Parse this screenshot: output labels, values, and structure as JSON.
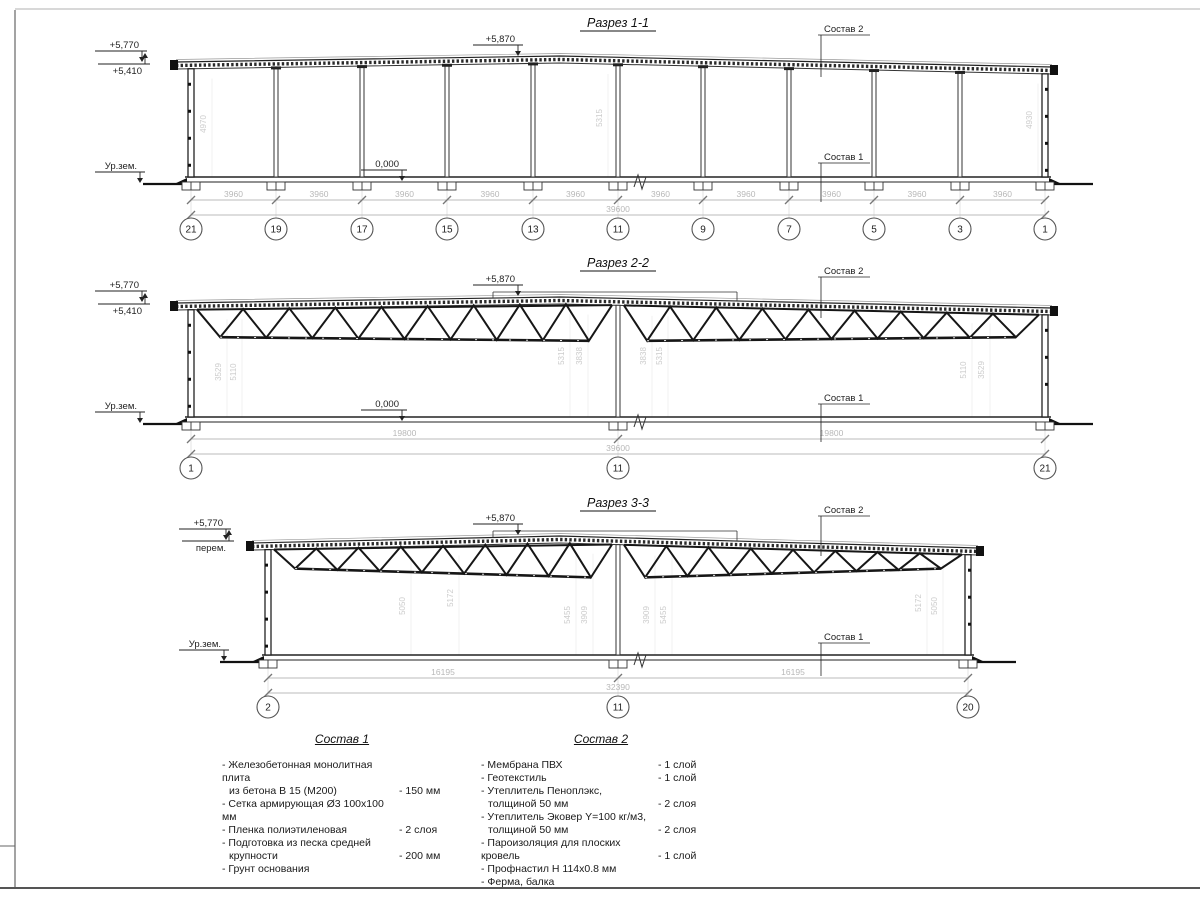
{
  "drawing": {
    "sections": {
      "s1": {
        "title": "Разрез 1-1",
        "elev_high": "+5,770",
        "elev_low": "+5,410",
        "ground_label": "Ур.зем.",
        "zero_mark": "0,000",
        "ridge": "+5,870",
        "sostav2_label": "Состав 2",
        "sostav1_label": "Состав 1",
        "bay_dims": [
          "3960",
          "3960",
          "3960",
          "3960",
          "3960",
          "3960",
          "3960",
          "3960",
          "3960",
          "3960"
        ],
        "total_dim": "39600",
        "axes": [
          "21",
          "19",
          "17",
          "15",
          "13",
          "11",
          "9",
          "7",
          "5",
          "3",
          "1"
        ],
        "vert_dims": [
          "4970",
          "5315",
          "4930"
        ]
      },
      "s2": {
        "title": "Разрез 2-2",
        "elev_high": "+5,770",
        "elev_low": "+5,410",
        "ground_label": "Ур.зем.",
        "zero_mark": "0,000",
        "ridge": "+5,870",
        "sostav2_label": "Состав 2",
        "sostav1_label": "Состав 1",
        "span_dims": [
          "19800",
          "19800"
        ],
        "total_dim": "39600",
        "axes": [
          "1",
          "11",
          "21"
        ],
        "vert_dims": [
          "3529",
          "5110",
          "5315",
          "3838",
          "3838",
          "5315",
          "5110",
          "3529"
        ]
      },
      "s3": {
        "title": "Разрез 3-3",
        "elev_high": "+5,770",
        "elev_low": "перем.",
        "ground_label": "Ур.зем.",
        "ridge": "+5,870",
        "sostav2_label": "Состав 2",
        "sostav1_label": "Состав 1",
        "span_dims": [
          "16195",
          "16195"
        ],
        "total_dim": "32390",
        "axes": [
          "2",
          "11",
          "20"
        ],
        "vert_dims": [
          "5050",
          "5172",
          "5455",
          "3909",
          "3909",
          "5455",
          "5172",
          "5050"
        ]
      }
    },
    "legend1": {
      "title": "Состав 1",
      "items": [
        {
          "l1": "- Железобетонная  монолитная плита",
          "l2": "из бетона В 15 (М200)",
          "value": "- 150 мм"
        },
        {
          "l1": "- Сетка армирующая Ø3 100x100 мм",
          "l2": "",
          "value": ""
        },
        {
          "l1": "- Пленка полиэтиленовая",
          "l2": "",
          "value": "- 2 слоя"
        },
        {
          "l1": "- Подготовка из песка средней",
          "l2": "крупности",
          "value": "- 200 мм"
        },
        {
          "l1": "- Грунт основания",
          "l2": "",
          "value": ""
        }
      ]
    },
    "legend2": {
      "title": "Состав 2",
      "items": [
        {
          "l1": "- Мембрана ПВХ",
          "l2": "",
          "value": "- 1 слой"
        },
        {
          "l1": "- Геотекстиль",
          "l2": "",
          "value": "- 1 слой"
        },
        {
          "l1": "- Утеплитель Пеноплэкс,",
          "l2": "толщиной 50 мм",
          "value": "- 2 слоя"
        },
        {
          "l1": "- Утеплитель Эковер Y=100 кг/м3,",
          "l2": "толщиной 50 мм",
          "value": "- 2 слоя"
        },
        {
          "l1": "- Пароизоляция для плоских кровель",
          "l2": "",
          "value": "- 1 слой"
        },
        {
          "l1": "- Профнастил Н 114х0.8 мм",
          "l2": "",
          "value": ""
        },
        {
          "l1": "- Ферма, балка",
          "l2": "",
          "value": ""
        }
      ]
    }
  }
}
